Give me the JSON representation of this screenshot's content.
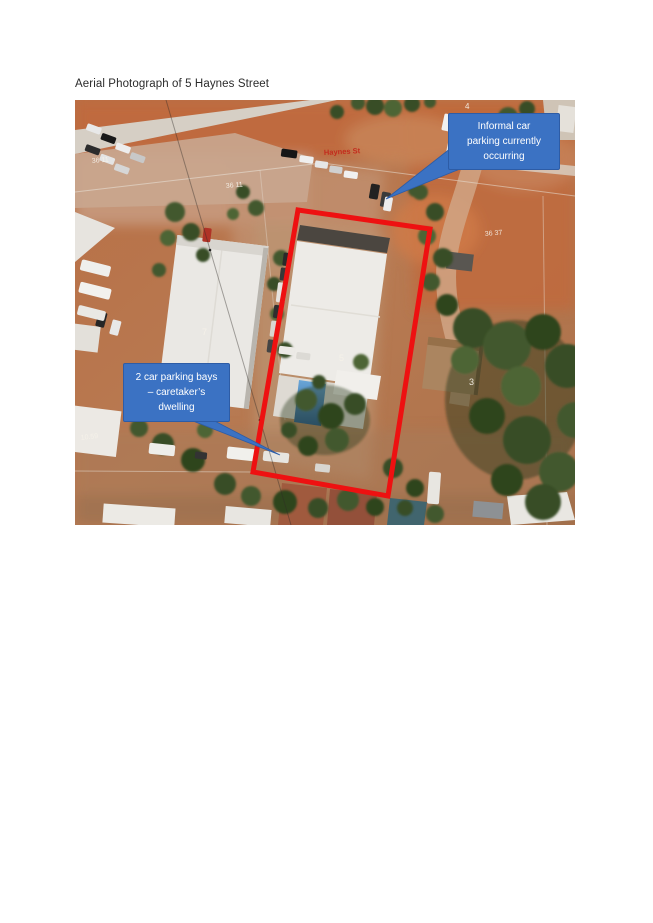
{
  "page": {
    "title": "Aerial Photograph of 5 Haynes Street"
  },
  "photo": {
    "street_label": "Haynes St",
    "lot_labels": [
      {
        "text": "36 11"
      },
      {
        "text": "36 11"
      },
      {
        "text": "4"
      },
      {
        "text": "36 37"
      },
      {
        "text": "7"
      },
      {
        "text": "5"
      },
      {
        "text": "3"
      },
      {
        "text": "10.59"
      }
    ],
    "callouts": [
      {
        "name": "informal-parking",
        "lines": [
          "Informal car",
          "parking currently",
          "occurring"
        ]
      },
      {
        "name": "caretaker-dwelling",
        "lines": [
          "2 car parking bays",
          "– caretaker’s",
          "dwelling"
        ]
      }
    ],
    "colors": {
      "boundary_red": "#ee1111",
      "callout_blue": "#3b72c3"
    }
  }
}
